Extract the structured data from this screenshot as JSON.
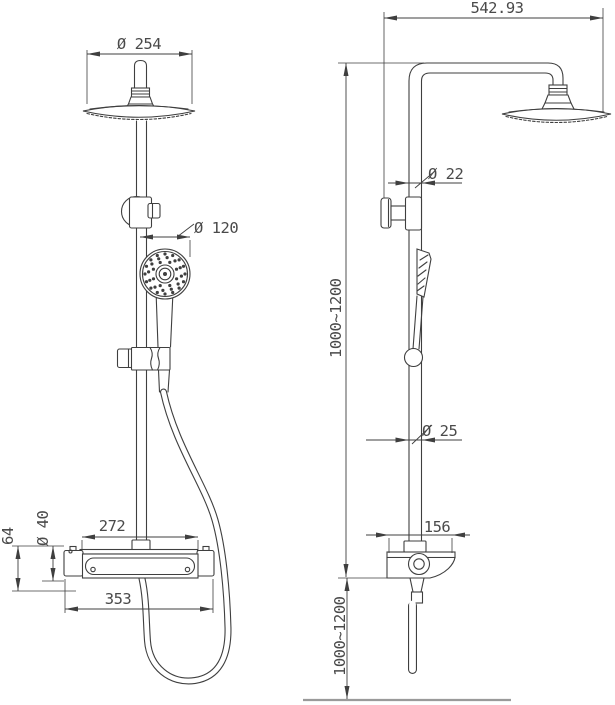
{
  "colors": {
    "line": "#3f3f3f",
    "text": "#4a4a4a",
    "floor_line": "#9a9a9a",
    "background": "#ffffff"
  },
  "front_view": {
    "overhead_shower_diameter": "Ø 254",
    "hand_shower_diameter": "Ø 120",
    "valve_inlet_spacing": "272",
    "valve_overall_width": "353",
    "valve_body_diameter": "Ø 40",
    "valve_height": "64"
  },
  "side_view": {
    "arm_projection": "542.93",
    "upper_pipe_diameter": "Ø 22",
    "lower_pipe_diameter": "Ø 25",
    "shelf_depth": "156",
    "upper_height_range": "1000~1200",
    "lower_height_range": "1000~1200"
  }
}
